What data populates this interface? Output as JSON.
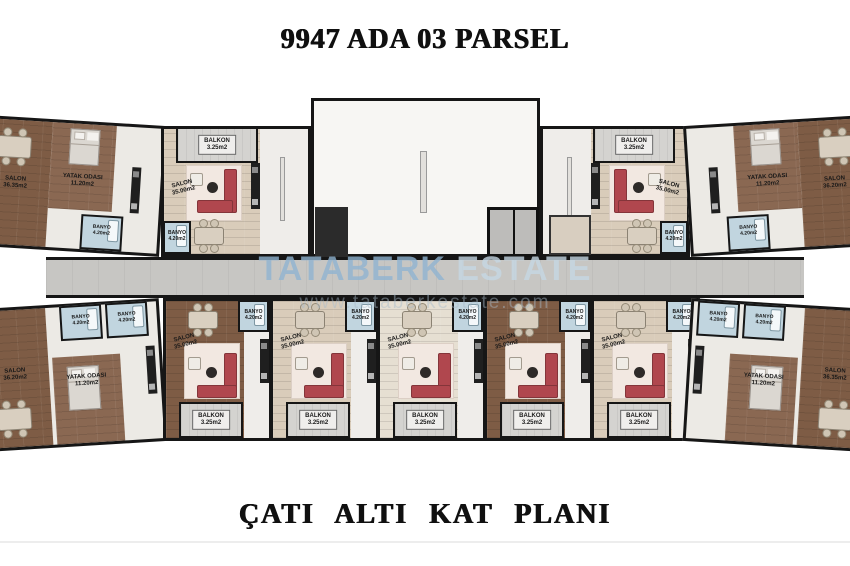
{
  "titles": {
    "top": "9947 ADA 03 PARSEL",
    "bottom": "ÇATI ALTI KAT PLANI"
  },
  "watermark": {
    "brand_strong": "TATABERK",
    "brand_light": "ESTATE",
    "url": "www.tataberkestate.com"
  },
  "room_labels": {
    "salon_tl": "SALON\n36.35m2",
    "salon_tr": "SALON\n36.20m2",
    "salon_bl": "SALON\n36.20m2",
    "salon_br": "SALON\n36.35m2",
    "salon_mid": "SALON\n35.00m2",
    "banyo": "BANYO\n4.20m2",
    "balkon": "BALKON\n3.25m2",
    "yatak": "YATAK ODASI\n11.20m2"
  },
  "colors": {
    "wall": "#161616",
    "sofa_red": "#b0474e",
    "wood_dark": "#7e5c45",
    "wood_light": "#d9ccba",
    "bathroom_blue": "#c1d5df",
    "corridor_gray": "#c7c6c3",
    "watermark_blue": "#8fb4d2"
  }
}
